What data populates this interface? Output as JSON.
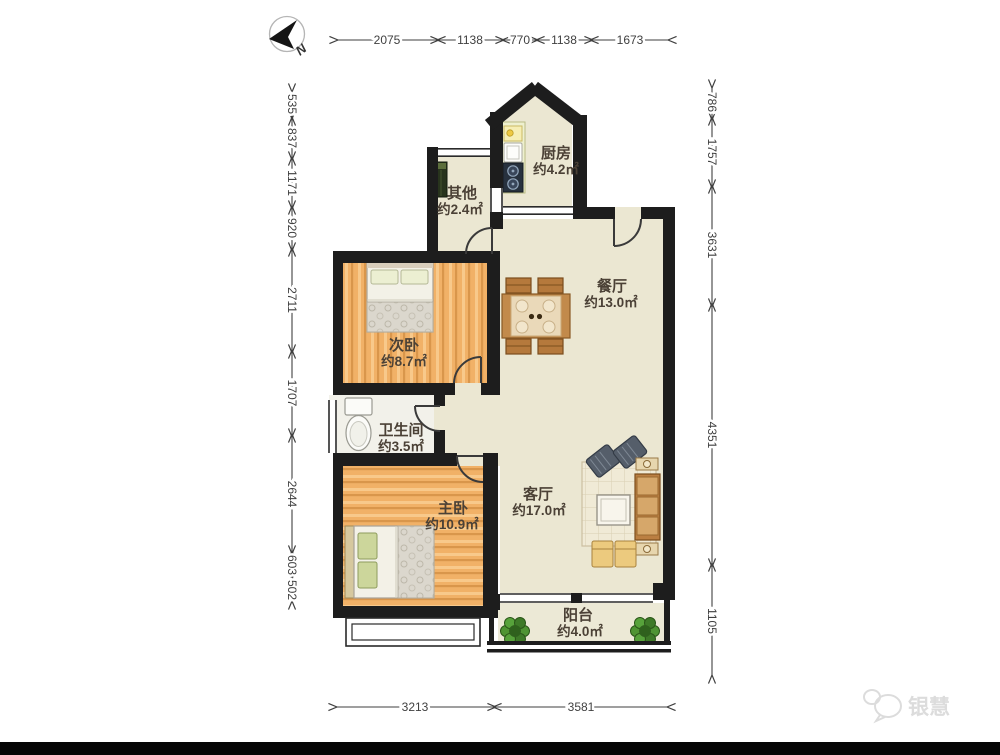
{
  "compass": {
    "label": "N"
  },
  "watermark": {
    "text": "银慧"
  },
  "rooms": [
    {
      "name": "厨房",
      "area": "约4.2㎡"
    },
    {
      "name": "其他",
      "area": "约2.4㎡"
    },
    {
      "name": "餐厅",
      "area": "约13.0㎡"
    },
    {
      "name": "次卧",
      "area": "约8.7㎡"
    },
    {
      "name": "卫生间",
      "area": "约3.5㎡"
    },
    {
      "name": "主卧",
      "area": "约10.9㎡"
    },
    {
      "name": "客厅",
      "area": "约17.0㎡"
    },
    {
      "name": "阳台",
      "area": "约4.0㎡"
    }
  ],
  "dimensions_mm": {
    "top": [
      "2075",
      "1138",
      "770",
      "1138",
      "1673"
    ],
    "left": [
      "535",
      "837",
      "1171",
      "920",
      "2711",
      "1707",
      "2644",
      "603",
      "502"
    ],
    "right": [
      "786",
      "1757",
      "3631",
      "4351",
      "1105"
    ],
    "bottom": [
      "3213",
      "3581"
    ]
  },
  "colors": {
    "wall": "#1d1d1d",
    "wood_floor": "#f1b167",
    "tile_floor": "#ebe7d2",
    "dimension_text": "#3f3f3f",
    "label_text": "#4b4136"
  }
}
